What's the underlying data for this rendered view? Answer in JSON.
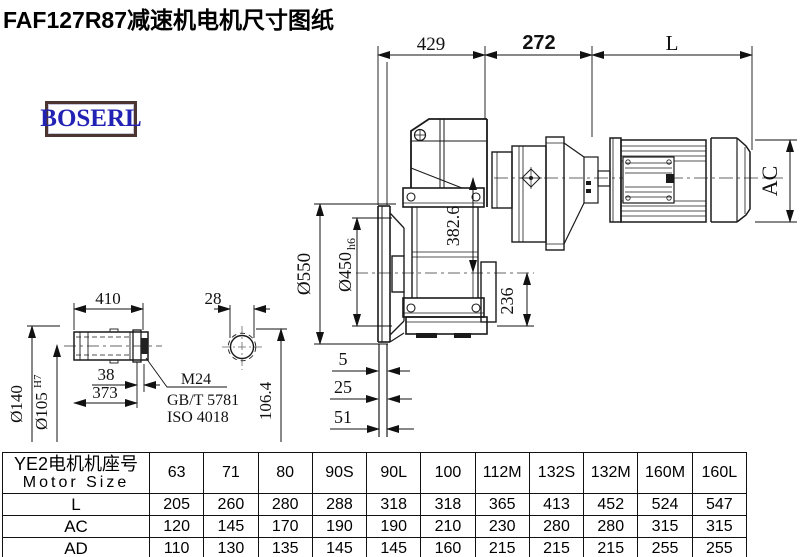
{
  "title": "FAF127R87减速机电机尺寸图纸",
  "logo": {
    "text": "BOSERL"
  },
  "drawing": {
    "dims": {
      "top_429": "429",
      "top_272": "272",
      "top_L": "L",
      "ac": "AC",
      "dia550": "Ø550",
      "dia450_main": "Ø450",
      "dia450_suffix": "h6",
      "v382": "382.6",
      "v236": "236",
      "off5": "5",
      "off25": "25",
      "off51": "51",
      "shaft_410": "410",
      "shaft_38": "38",
      "shaft_373": "373",
      "dia140": "Ø140",
      "dia105_main": "Ø105",
      "dia105_suffix": "H7",
      "sec_28": "28",
      "sec_106": "106.4",
      "thread": "M24",
      "std1": "GB/T 5781",
      "std2": "ISO 4018"
    }
  },
  "table": {
    "header_cn": "YE2电机机座号",
    "header_en": "Motor Size",
    "columns": [
      "63",
      "71",
      "80",
      "90S",
      "90L",
      "100",
      "112M",
      "132S",
      "132M",
      "160M",
      "160L"
    ],
    "rows": [
      {
        "label": "L",
        "values": [
          "205",
          "260",
          "280",
          "288",
          "318",
          "318",
          "365",
          "413",
          "452",
          "524",
          "547"
        ]
      },
      {
        "label": "AC",
        "values": [
          "120",
          "145",
          "170",
          "190",
          "190",
          "210",
          "230",
          "280",
          "280",
          "315",
          "315"
        ]
      },
      {
        "label": "AD",
        "values": [
          "110",
          "130",
          "135",
          "145",
          "145",
          "160",
          "215",
          "215",
          "215",
          "255",
          "255"
        ]
      }
    ]
  },
  "colors": {
    "line": "#1a1a1a",
    "centerline": "#666",
    "logo_blue": "#2222b4",
    "logo_border": "#4c3430"
  }
}
